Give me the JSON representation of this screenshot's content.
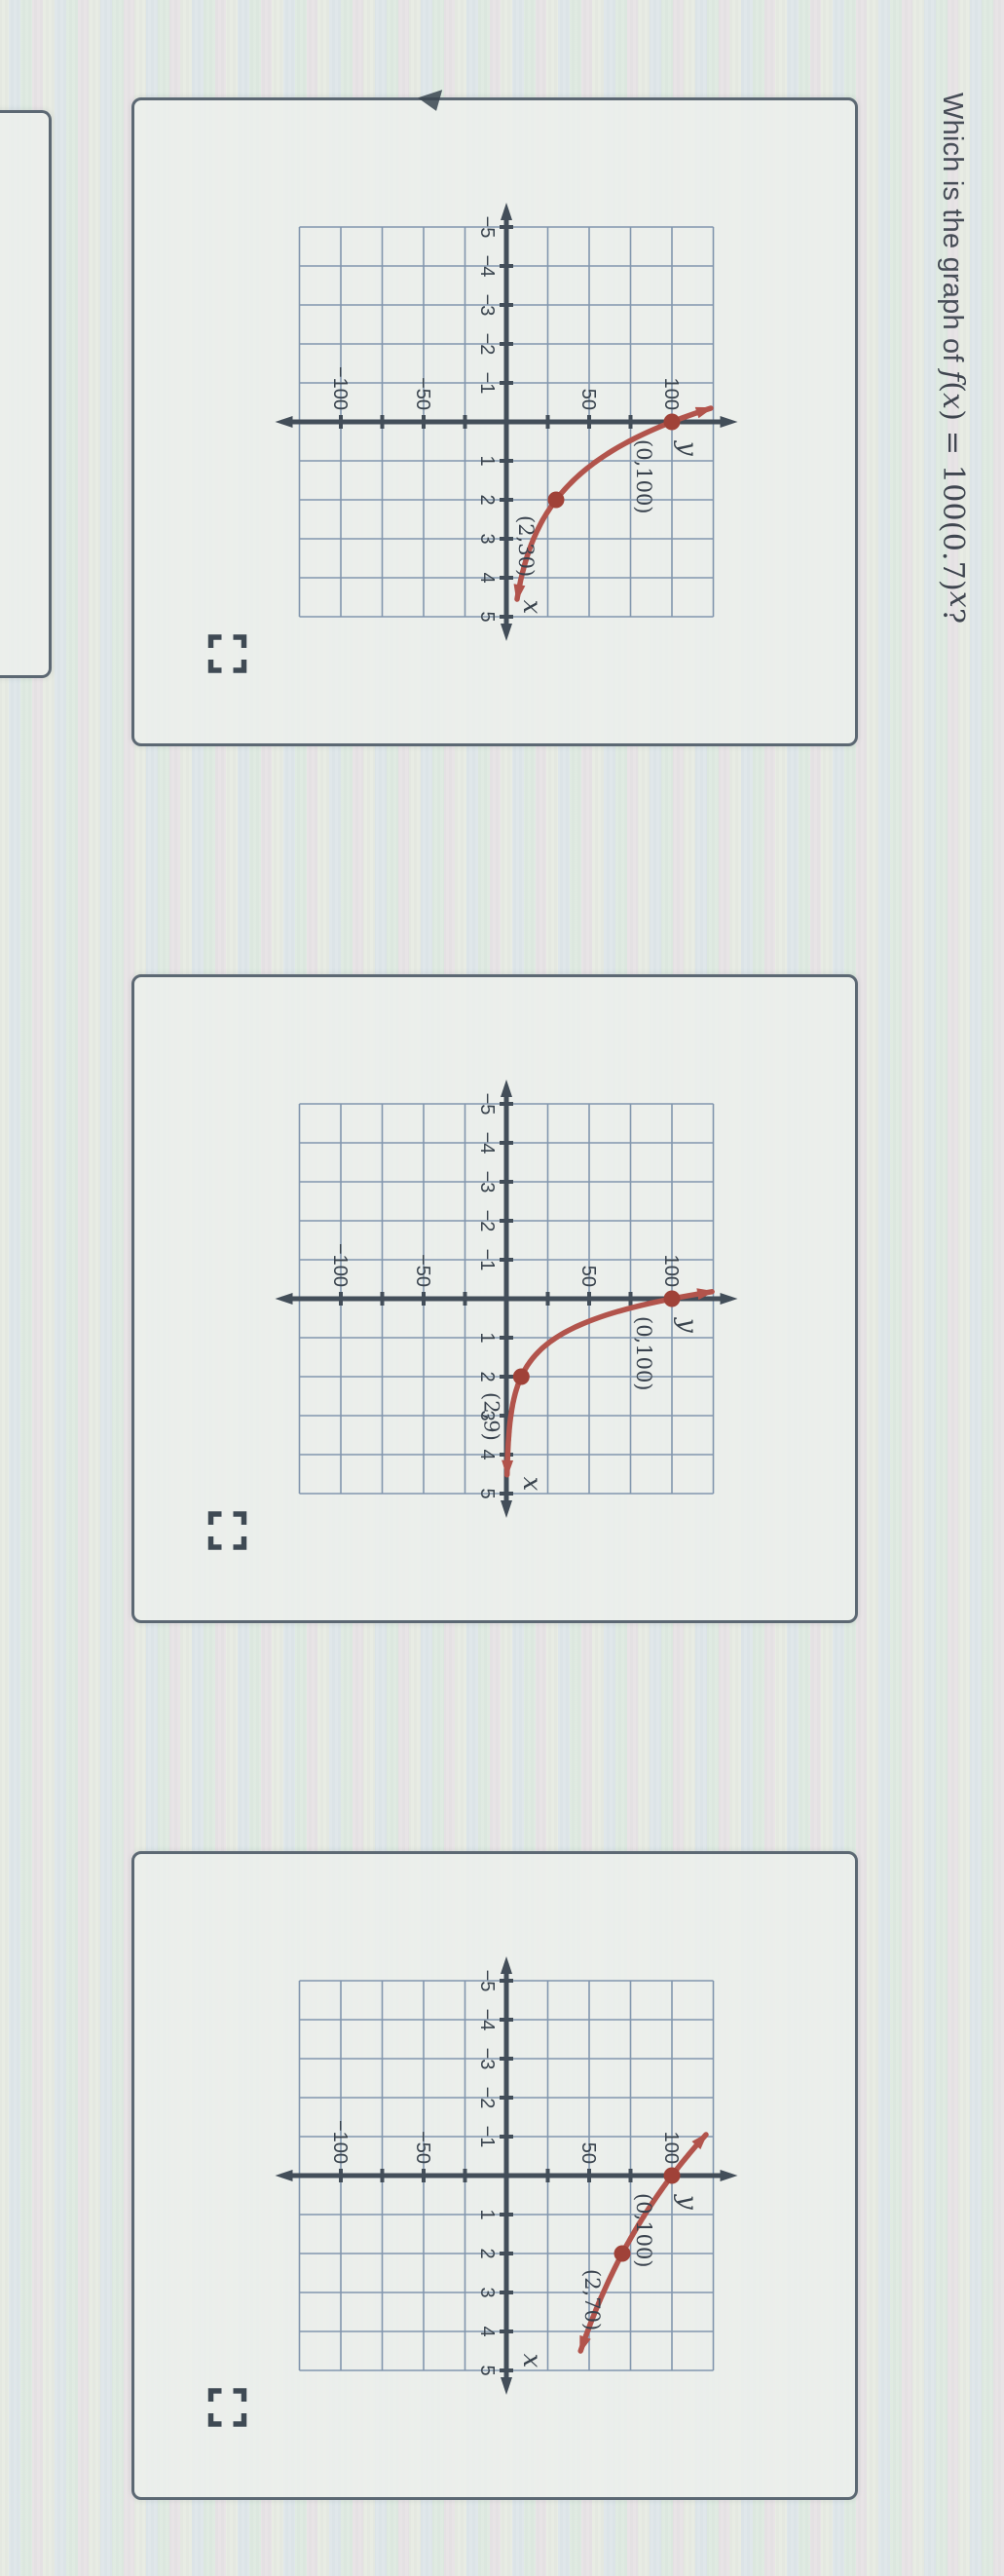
{
  "question": {
    "prefix": "Which is the graph of ",
    "f": "f",
    "open": "(",
    "x1": "x",
    "mid": ") = 100(0.7)",
    "sup": "x",
    "end": "?"
  },
  "colors": {
    "curve": "#b2544c",
    "dot": "#a04238",
    "grid": "#8296ae",
    "axis": "#434e59",
    "tick_text": "#39434d",
    "point_label": "#3a434e",
    "bracket": "#3f4a54",
    "card_border": "#5c6873"
  },
  "axis": {
    "x_label": "x",
    "y_label": "y",
    "x_ticks": [
      -5,
      -4,
      -3,
      -2,
      -1,
      1,
      2,
      3,
      4,
      5
    ],
    "x_tick_labels": [
      "−5",
      "−4",
      "−3",
      "−2",
      "−1",
      "1",
      "2",
      "3",
      "4",
      "5"
    ],
    "y_ticks": [
      {
        "v": 100,
        "label": "100"
      },
      {
        "v": 50,
        "label": "50"
      },
      {
        "v": -50,
        "label": "−50"
      },
      {
        "v": -100,
        "label": "−100"
      }
    ]
  },
  "graphs": [
    {
      "option": "option-1",
      "base": 0.5477,
      "x_start": -0.35,
      "x_end": 4.55,
      "points": [
        {
          "x": 0,
          "y": 100,
          "label": "(0,100)"
        },
        {
          "x": 2,
          "y": 30,
          "label": "(2,30)"
        }
      ]
    },
    {
      "option": "option-2",
      "base": 0.3,
      "x_start": -0.18,
      "x_end": 4.55,
      "points": [
        {
          "x": 0,
          "y": 100,
          "label": "(0,100)"
        },
        {
          "x": 2,
          "y": 9,
          "label": "(2,9)"
        }
      ]
    },
    {
      "option": "option-3",
      "base": 0.8367,
      "x_start": -1.05,
      "x_end": 4.5,
      "points": [
        {
          "x": 0,
          "y": 100,
          "label": "(0,100)"
        },
        {
          "x": 2,
          "y": 70,
          "label": "(2,70)"
        }
      ]
    }
  ],
  "chart_data": [
    {
      "type": "line",
      "title": "Answer option 1 graph",
      "xlabel": "x",
      "ylabel": "y",
      "xlim": [
        -5,
        5
      ],
      "ylim": [
        -125,
        125
      ],
      "x_gridline_step": 1,
      "y_gridline_step": 25,
      "x_tick_labels": [
        -5,
        -4,
        -3,
        -2,
        -1,
        1,
        2,
        3,
        4,
        5
      ],
      "y_tick_labels": [
        -100,
        -50,
        50,
        100
      ],
      "grid": true,
      "legend": false,
      "function": "exponential decay y = 100*(0.548)^x, arrows on both curve ends",
      "labeled_points": [
        [
          0,
          100
        ],
        [
          2,
          30
        ]
      ],
      "series": [
        {
          "name": "curve",
          "x": [
            -0.35,
            0,
            1,
            2,
            3,
            4,
            4.55
          ],
          "values": [
            123,
            100,
            55,
            30,
            16.4,
            9,
            6.4
          ]
        }
      ]
    },
    {
      "type": "line",
      "title": "Answer option 2 graph",
      "xlabel": "x",
      "ylabel": "y",
      "xlim": [
        -5,
        5
      ],
      "ylim": [
        -125,
        125
      ],
      "x_gridline_step": 1,
      "y_gridline_step": 25,
      "x_tick_labels": [
        -5,
        -4,
        -3,
        -2,
        -1,
        1,
        2,
        3,
        4,
        5
      ],
      "y_tick_labels": [
        -100,
        -50,
        50,
        100
      ],
      "grid": true,
      "legend": false,
      "function": "exponential decay y = 100*(0.30)^x, arrows on both curve ends",
      "labeled_points": [
        [
          0,
          100
        ],
        [
          2,
          9
        ]
      ],
      "series": [
        {
          "name": "curve",
          "x": [
            -0.18,
            0,
            1,
            2,
            3,
            4,
            4.55
          ],
          "values": [
            124,
            100,
            30,
            9,
            2.7,
            0.8,
            0.4
          ]
        }
      ]
    },
    {
      "type": "line",
      "title": "Answer option 3 graph",
      "xlabel": "x",
      "ylabel": "y",
      "xlim": [
        -5,
        5
      ],
      "ylim": [
        -125,
        125
      ],
      "x_gridline_step": 1,
      "y_gridline_step": 25,
      "x_tick_labels": [
        -5,
        -4,
        -3,
        -2,
        -1,
        1,
        2,
        3,
        4,
        5
      ],
      "y_tick_labels": [
        -100,
        -50,
        50,
        100
      ],
      "grid": true,
      "legend": false,
      "function": "exponential decay y = 100*(0.837)^x, arrows on both curve ends",
      "labeled_points": [
        [
          0,
          100
        ],
        [
          2,
          70
        ]
      ],
      "series": [
        {
          "name": "curve",
          "x": [
            -1.05,
            0,
            1,
            2,
            3,
            4,
            4.5
          ],
          "values": [
            121,
            100,
            84,
            70,
            58.6,
            49,
            44.8
          ]
        }
      ]
    }
  ]
}
